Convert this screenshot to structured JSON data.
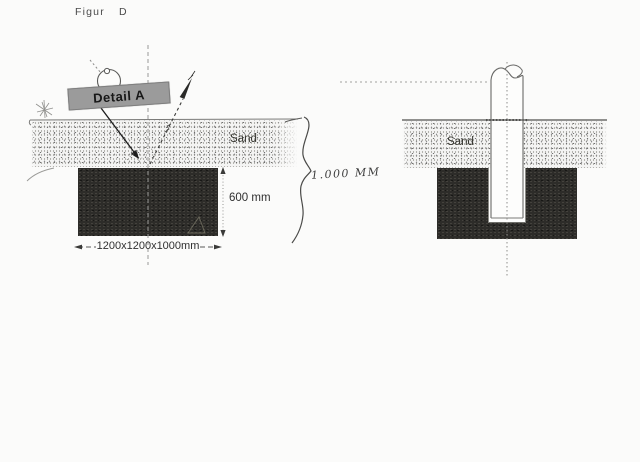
{
  "header": {
    "word": "Figur",
    "letter": "D"
  },
  "left_diagram": {
    "detail_label": "Detail A",
    "sand_label": "Sand",
    "depth_label": "600 mm",
    "size_label": "1200x1200x1000mm",
    "handwritten_label": "1.000 MM"
  },
  "right_diagram": {
    "sand_label": "Sand"
  },
  "colors": {
    "paper": "#fbfbfa",
    "concrete_block": "#2d2c29",
    "sand_dots": "#8a8a8a",
    "ink": "#3c3c3c",
    "detail_label_bg": "#9b9b9b"
  }
}
